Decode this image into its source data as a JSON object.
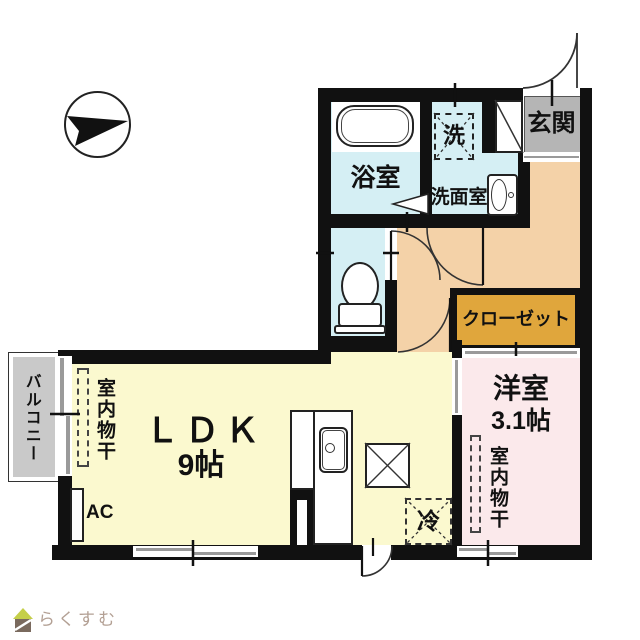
{
  "plan": {
    "type": "floorplan-japanese-apartment",
    "compass": "arrow-pointing-right"
  },
  "rooms": {
    "entrance": {
      "label": "玄関",
      "color": "#b5b5b5"
    },
    "bathroom": {
      "label": "浴室",
      "color": "#d5eff4"
    },
    "washroom": {
      "label": "洗面室",
      "color": "#d5eff4"
    },
    "toilet": {
      "color": "#d5eff4"
    },
    "hallway": {
      "color": "#f4d2a8"
    },
    "closet": {
      "label": "クローゼット",
      "color": "#e0a63c"
    },
    "ldk": {
      "label": "ＬＤＫ",
      "size": "9帖",
      "color": "#fbf9cf"
    },
    "western": {
      "label": "洋室",
      "size": "3.1帖",
      "color": "#fbe9eb"
    },
    "balcony": {
      "label": "バルコニー",
      "color": "#c9c9c9"
    }
  },
  "fixtures": {
    "washer": "洗",
    "fridge": "冷",
    "ac": "AC",
    "drying": "室内物干"
  },
  "logo": {
    "text": "らくすむ",
    "text_color": "#b3a094",
    "roof_color": "#c5cf4a",
    "body_color": "#7a6a5e"
  },
  "colors": {
    "wall": "#111111",
    "window_gray": "#9a9a9a",
    "line": "#333333"
  }
}
